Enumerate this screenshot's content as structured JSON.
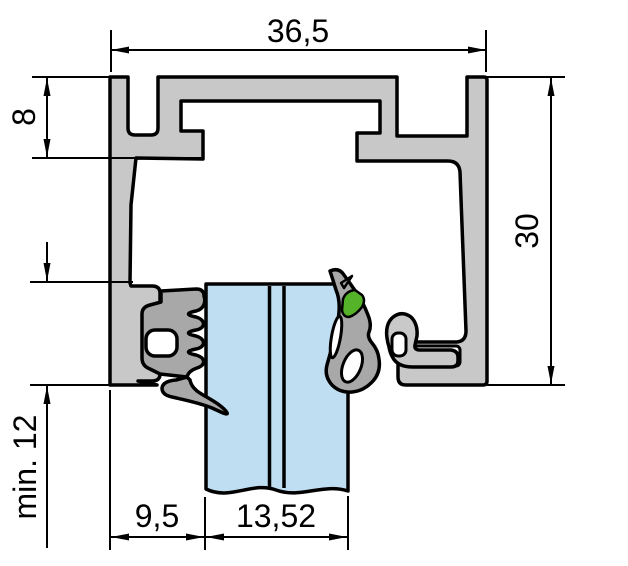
{
  "drawing": {
    "title": "glazing-profile-cross-section",
    "dimensions": {
      "overall_width_mm": "36,5",
      "top_groove_height_mm": "8",
      "profile_height_mm": "30",
      "min_glass_insertion_mm": "min. 12",
      "left_rebate_mm": "9,5",
      "glass_thickness_mm": "13,52"
    },
    "colors": {
      "aluminium": "#c8c8c8",
      "gasket": "#a8a8a8",
      "clip": "#c9c9c9",
      "glass": "#bfdef2",
      "marker_green": "#55b32a",
      "outline": "#000000",
      "background": "#ffffff"
    }
  }
}
